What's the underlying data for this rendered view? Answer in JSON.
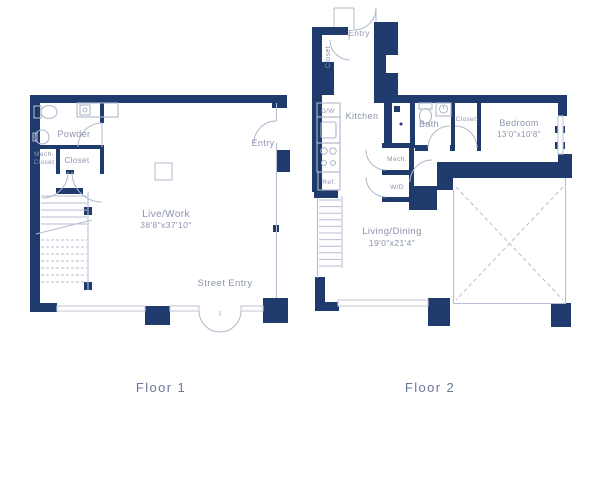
{
  "floor1": {
    "label": "Floor 1",
    "rooms": {
      "powder": "Powder",
      "mech_closet_line1": "Mech.",
      "mech_closet_line2": "Closet",
      "closet": "Closet",
      "entry": "Entry",
      "live_work": "Live/Work",
      "live_work_dims": "38'8\"x37'10\"",
      "street_entry": "Street Entry"
    }
  },
  "floor2": {
    "label": "Floor 2",
    "rooms": {
      "entry": "Entry",
      "entry_closet": "Closet",
      "kitchen": "Kitchen",
      "dishwasher": "D/W",
      "refrigerator": "Ref.",
      "mech": "Mech.",
      "washer_dryer": "W/D",
      "bath": "Bath",
      "closet": "Closet",
      "bedroom": "Bedroom",
      "bedroom_dims": "13'0\"x10'8\"",
      "living_dining": "Living/Dining",
      "living_dining_dims": "19'0\"x21'4\""
    }
  },
  "colors": {
    "wall": "#1f3a6c",
    "line": "#b7bed0",
    "window": "#c6cbd9",
    "fixture": "#b0b8cc",
    "text": "#8b94ae",
    "floor_label": "#6b769c"
  }
}
